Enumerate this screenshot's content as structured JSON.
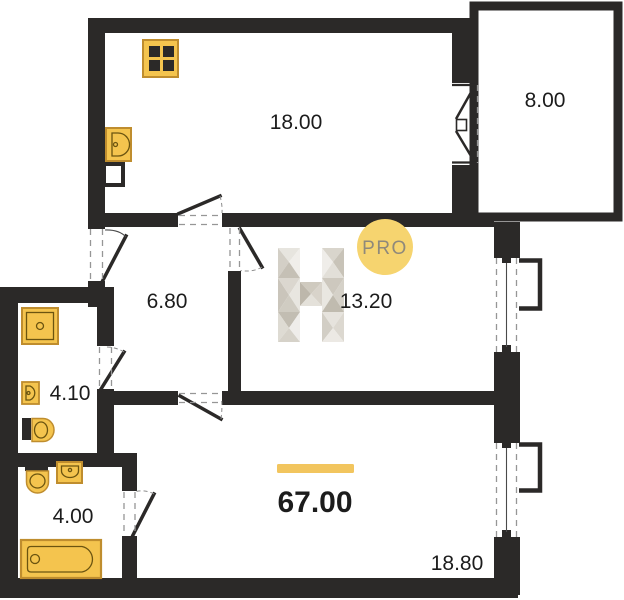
{
  "plan": {
    "rooms": [
      {
        "name": "kitchen-living-room",
        "area_label": "18.00"
      },
      {
        "name": "balcony",
        "area_label": "8.00"
      },
      {
        "name": "hallway",
        "area_label": "6.80"
      },
      {
        "name": "middle-room",
        "area_label": "13.20"
      },
      {
        "name": "bathroom-upper",
        "area_label": "4.10"
      },
      {
        "name": "bathroom-lower",
        "area_label": "4.00"
      },
      {
        "name": "bedroom",
        "area_label": "18.80"
      }
    ],
    "total_area_label": "67.00",
    "watermark": {
      "logo_letter": "H",
      "badge_text": "PRO"
    },
    "icons": [
      "stove-icon",
      "kitchen-sink-icon",
      "vent-duct-icon",
      "washing-machine-icon",
      "bathroom-sink-icon",
      "toilet-icon",
      "toilet-icon-2",
      "bathroom-sink-icon-2",
      "bathtub-icon",
      "window-icon",
      "door-swing-icon",
      "accordion-door-icon"
    ],
    "colors": {
      "wall": "#2b2928",
      "fixture_fill": "#f4c44e",
      "fixture_border": "#bf8d2e",
      "accent_bar": "#f2c55e",
      "badge_fill": "#f6d46f",
      "badge_text": "#8f897b",
      "label_text": "#1c1c1c"
    }
  }
}
